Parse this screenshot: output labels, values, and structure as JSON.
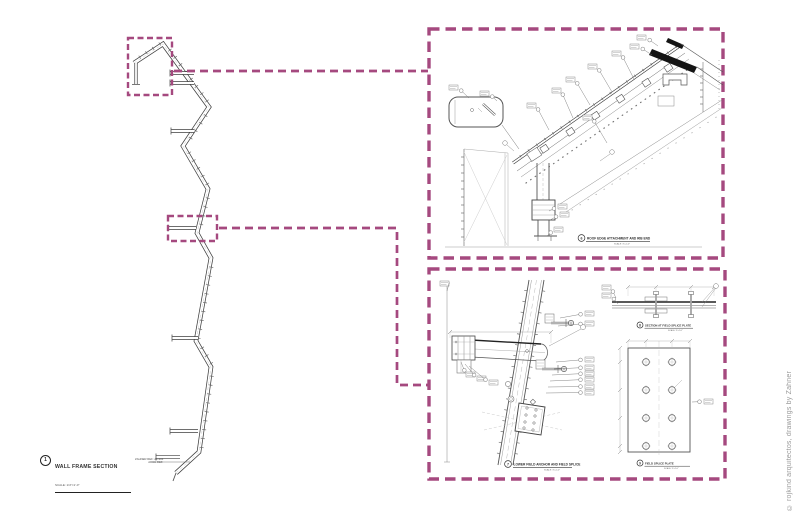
{
  "colors": {
    "callout": "#a5497f",
    "line": "#555555",
    "muted": "#9a9a9a"
  },
  "left_section": {
    "title_block": {
      "number": "1",
      "title": "WALL FRAME SECTION",
      "scale": "SCALE: 1/4″=1′-0″",
      "zahner_ref": "ZAHNER REF: Z1-304",
      "arch_ref": "ARCH REF:"
    }
  },
  "details": {
    "top": {
      "number": "6",
      "caption": "ROOF EDGE ATTACHMENT AND RIB END",
      "scale": "SCALE: 3″=1′-0″"
    },
    "bottom_main": {
      "number": "7",
      "caption": "LOWER FIELD ANCHOR AND FIELD SPLICE",
      "scale": "SCALE: 3″=1′-0″"
    },
    "splice_section": {
      "number": "8",
      "caption": "SECTION AT FIELD SPLICE PLATE",
      "scale": "SCALE: 3″=1′-0″"
    },
    "splice_plate": {
      "number": "9",
      "caption": "FIELD SPLICE PLATE",
      "scale": "SCALE: 3″=1′-0″"
    }
  },
  "footer": {
    "copyright": "© rojkind arquitectos, drawings by Zahner"
  }
}
